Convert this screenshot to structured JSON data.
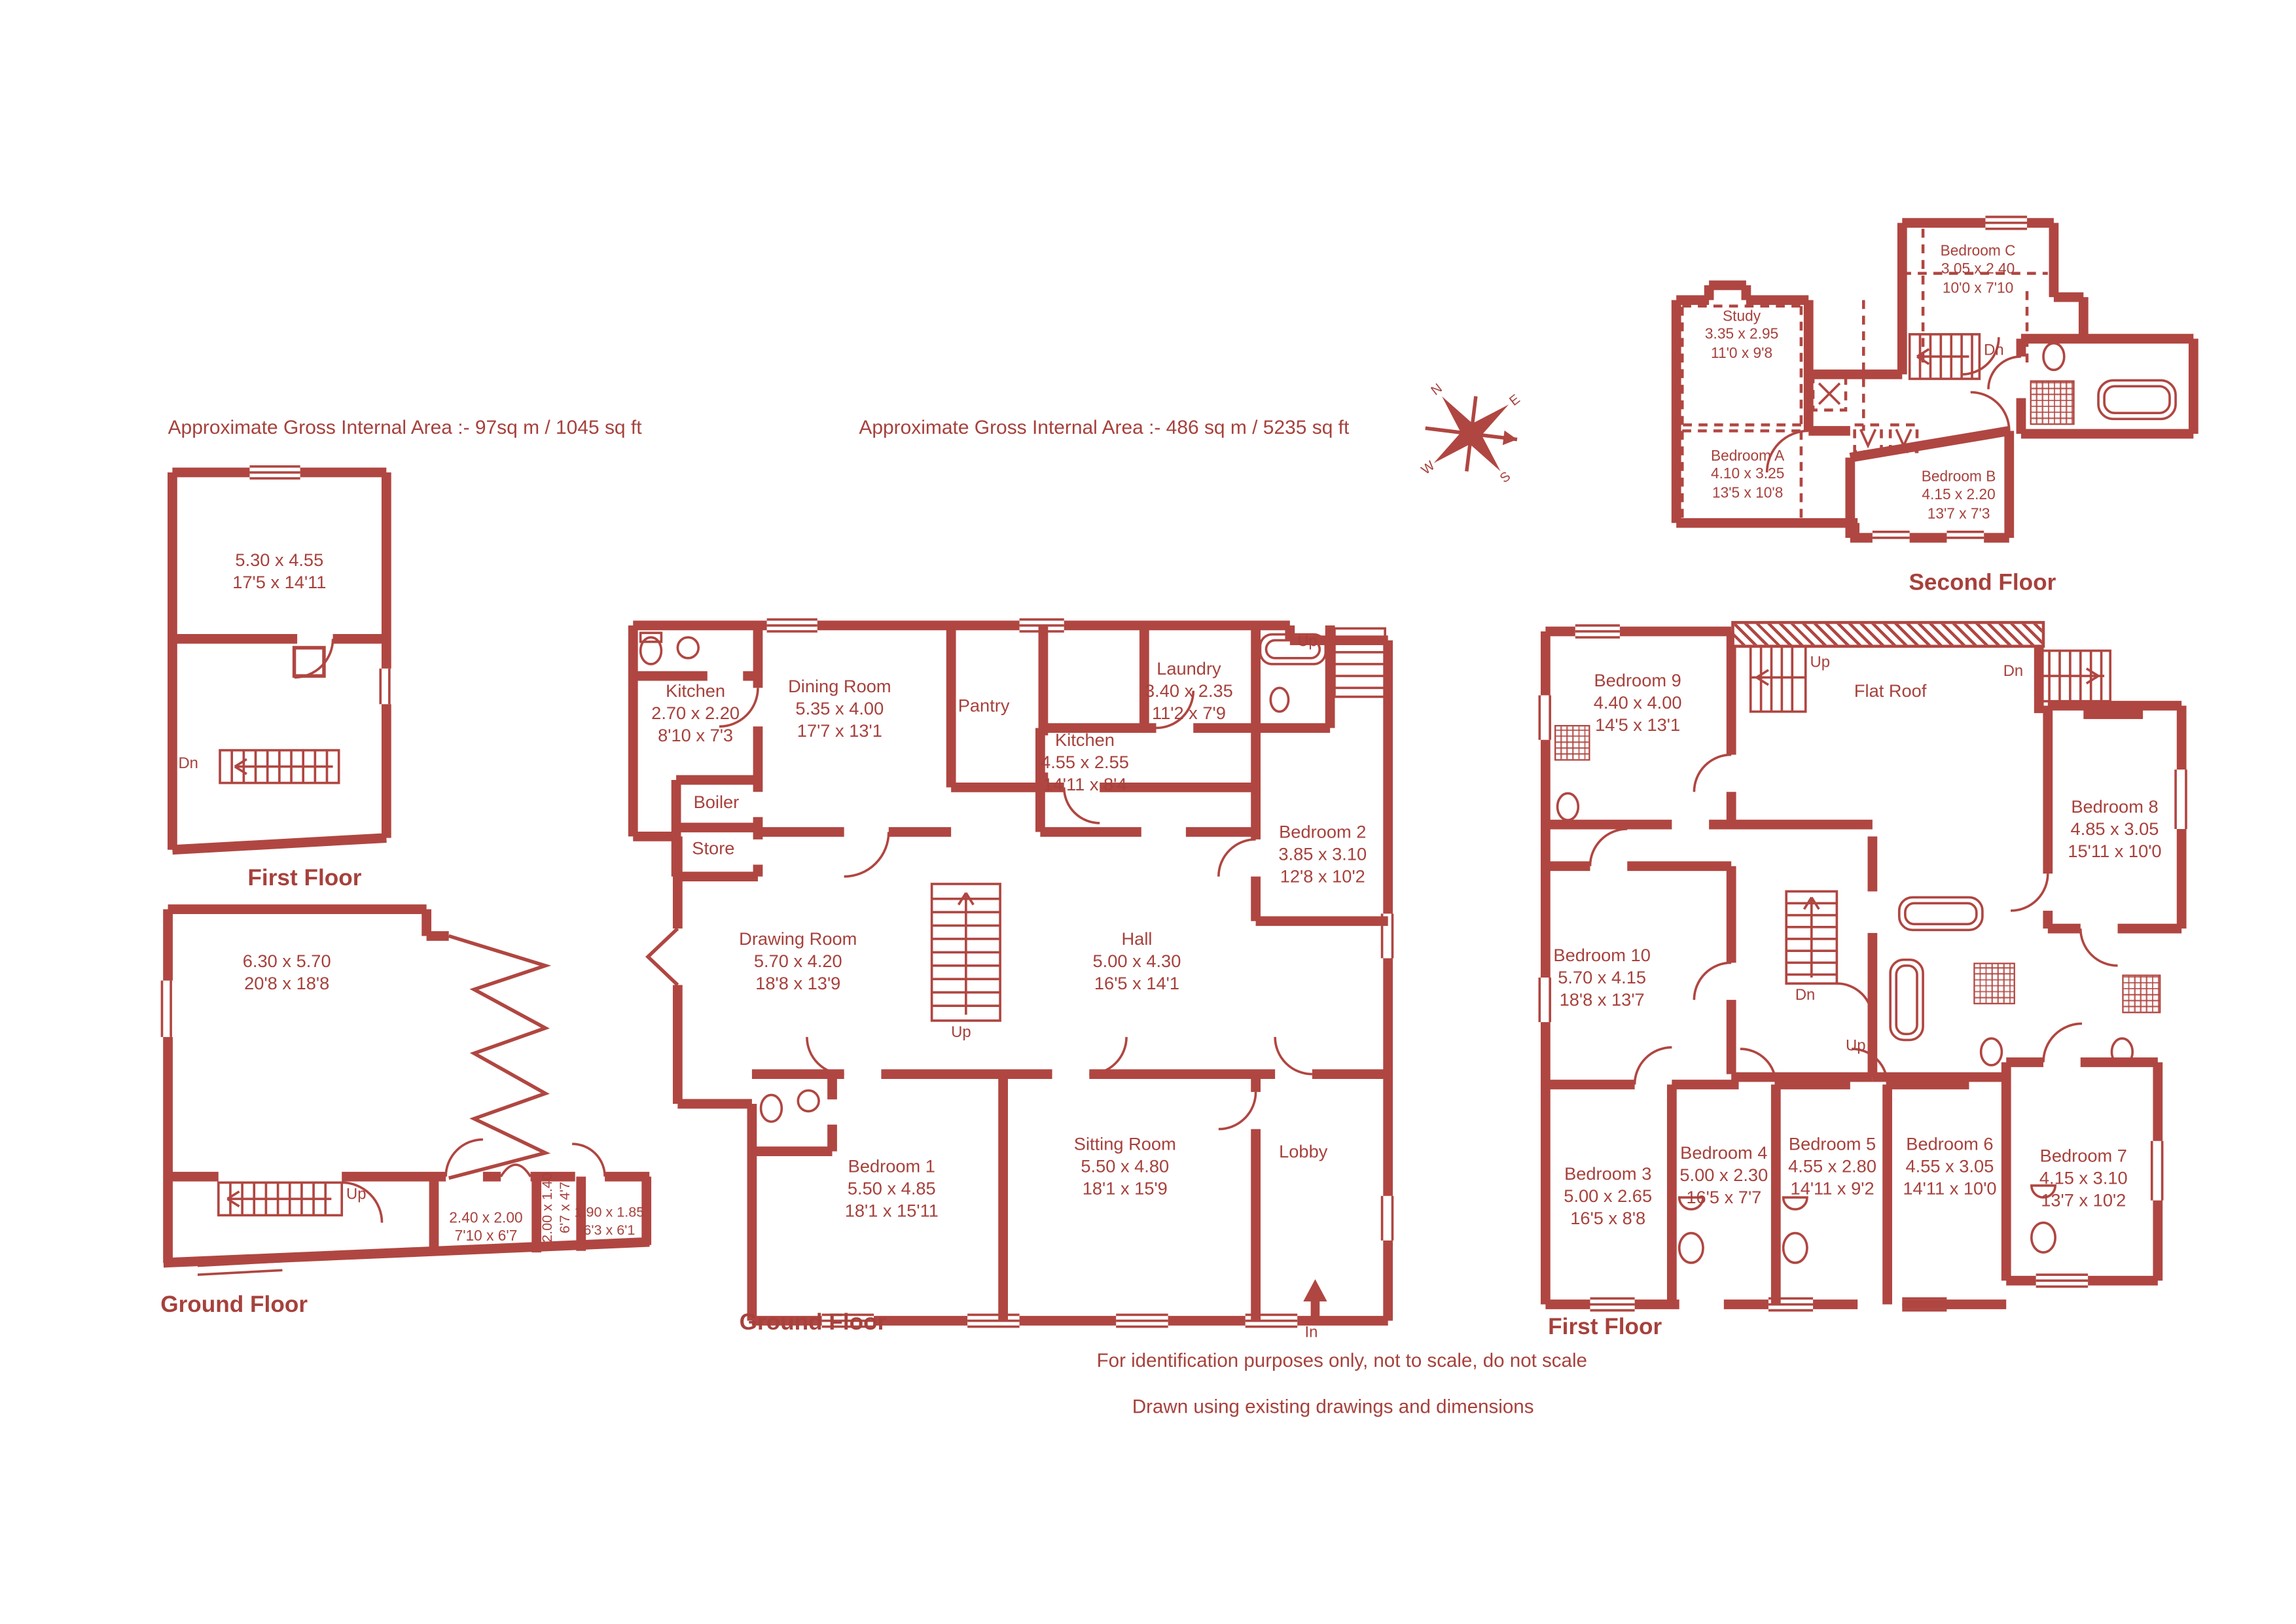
{
  "colors": {
    "accent": "#b04641",
    "text": "#a6413c"
  },
  "header": {
    "area_annexe": "Approximate Gross Internal Area  :-    97sq m /  1045 sq ft",
    "area_main": "Approximate Gross Internal Area  :-    486 sq m /  5235 sq ft"
  },
  "compass": {
    "n": "N",
    "e": "E",
    "s": "S",
    "w": "W"
  },
  "footer": {
    "line1": "For identification purposes only, not to scale, do not scale",
    "line2": "Drawn using existing drawings and dimensions"
  },
  "plans": {
    "annexe_first": {
      "title": "First Floor",
      "room": {
        "m": "5.30 x 4.55",
        "ft": "17'5 x 14'11"
      },
      "stairs_down": "Dn"
    },
    "annexe_ground": {
      "title": "Ground Floor",
      "main_room": {
        "m": "6.30 x 5.70",
        "ft": "20'8 x 18'8"
      },
      "store_1": {
        "m": "2.40 x 2.00",
        "ft": "7'10 x 6'7"
      },
      "store_2": {
        "m": "2.00 x 1.40",
        "ft": "6'7 x 4'7"
      },
      "store_3": {
        "m": "1.90 x 1.85",
        "ft": "6'3 x 6'1"
      },
      "stairs_up": "Up"
    },
    "main_ground": {
      "title": "Ground Floor",
      "kitchen_small": {
        "name": "Kitchen",
        "m": "2.70 x 2.20",
        "ft": "8'10 x 7'3"
      },
      "dining_room": {
        "name": "Dining Room",
        "m": "5.35 x 4.00",
        "ft": "17'7 x 13'1"
      },
      "pantry": {
        "name": "Pantry"
      },
      "laundry": {
        "name": "Laundry",
        "m": "3.40 x 2.35",
        "ft": "11'2 x 7'9"
      },
      "kitchen_main": {
        "name": "Kitchen",
        "m": "4.55 x 2.55",
        "ft": "14'11 x 8'4"
      },
      "boiler": {
        "name": "Boiler"
      },
      "store": {
        "name": "Store"
      },
      "bedroom_2": {
        "name": "Bedroom 2",
        "m": "3.85 x 3.10",
        "ft": "12'8 x 10'2"
      },
      "drawing_room": {
        "name": "Drawing Room",
        "m": "5.70 x 4.20",
        "ft": "18'8 x 13'9"
      },
      "hall": {
        "name": "Hall",
        "m": "5.00 x 4.30",
        "ft": "16'5 x 14'1"
      },
      "bedroom_1": {
        "name": "Bedroom 1",
        "m": "5.50 x 4.85",
        "ft": "18'1 x 15'11"
      },
      "sitting_room": {
        "name": "Sitting Room",
        "m": "5.50 x 4.80",
        "ft": "18'1 x 15'9"
      },
      "lobby": {
        "name": "Lobby"
      },
      "stairs_up_back": "Up",
      "stairs_up_main": "Up",
      "entrance": "In"
    },
    "main_first": {
      "title": "First Floor",
      "bedroom_9": {
        "name": "Bedroom 9",
        "m": "4.40 x 4.00",
        "ft": "14'5 x 13'1"
      },
      "flat_roof": {
        "name": "Flat Roof"
      },
      "bedroom_8": {
        "name": "Bedroom 8",
        "m": "4.85 x 3.05",
        "ft": "15'11 x 10'0"
      },
      "bedroom_10": {
        "name": "Bedroom 10",
        "m": "5.70 x 4.15",
        "ft": "18'8 x 13'7"
      },
      "bedroom_3": {
        "name": "Bedroom 3",
        "m": "5.00 x 2.65",
        "ft": "16'5 x 8'8"
      },
      "bedroom_4": {
        "name": "Bedroom 4",
        "m": "5.00 x 2.30",
        "ft": "16'5 x 7'7"
      },
      "bedroom_5": {
        "name": "Bedroom 5",
        "m": "4.55 x 2.80",
        "ft": "14'11 x 9'2"
      },
      "bedroom_6": {
        "name": "Bedroom 6",
        "m": "4.55 x 3.05",
        "ft": "14'11 x 10'0"
      },
      "bedroom_7": {
        "name": "Bedroom 7",
        "m": "4.15 x 3.10",
        "ft": "13'7 x 10'2"
      },
      "stairs_up_top": "Up",
      "stairs_dn_top": "Dn",
      "stairs_dn_mid": "Dn",
      "stairs_up_mid": "Up"
    },
    "second": {
      "title": "Second Floor",
      "bedroom_c": {
        "name": "Bedroom C",
        "m": "3.05 x 2.40",
        "ft": "10'0 x 7'10"
      },
      "study": {
        "name": "Study",
        "m": "3.35 x 2.95",
        "ft": "11'0 x 9'8"
      },
      "bedroom_a": {
        "name": "Bedroom A",
        "m": "4.10 x 3.25",
        "ft": "13'5 x 10'8"
      },
      "bedroom_b": {
        "name": "Bedroom B",
        "m": "4.15 x 2.20",
        "ft": "13'7 x 7'3"
      },
      "stairs_dn": "Dn"
    }
  }
}
